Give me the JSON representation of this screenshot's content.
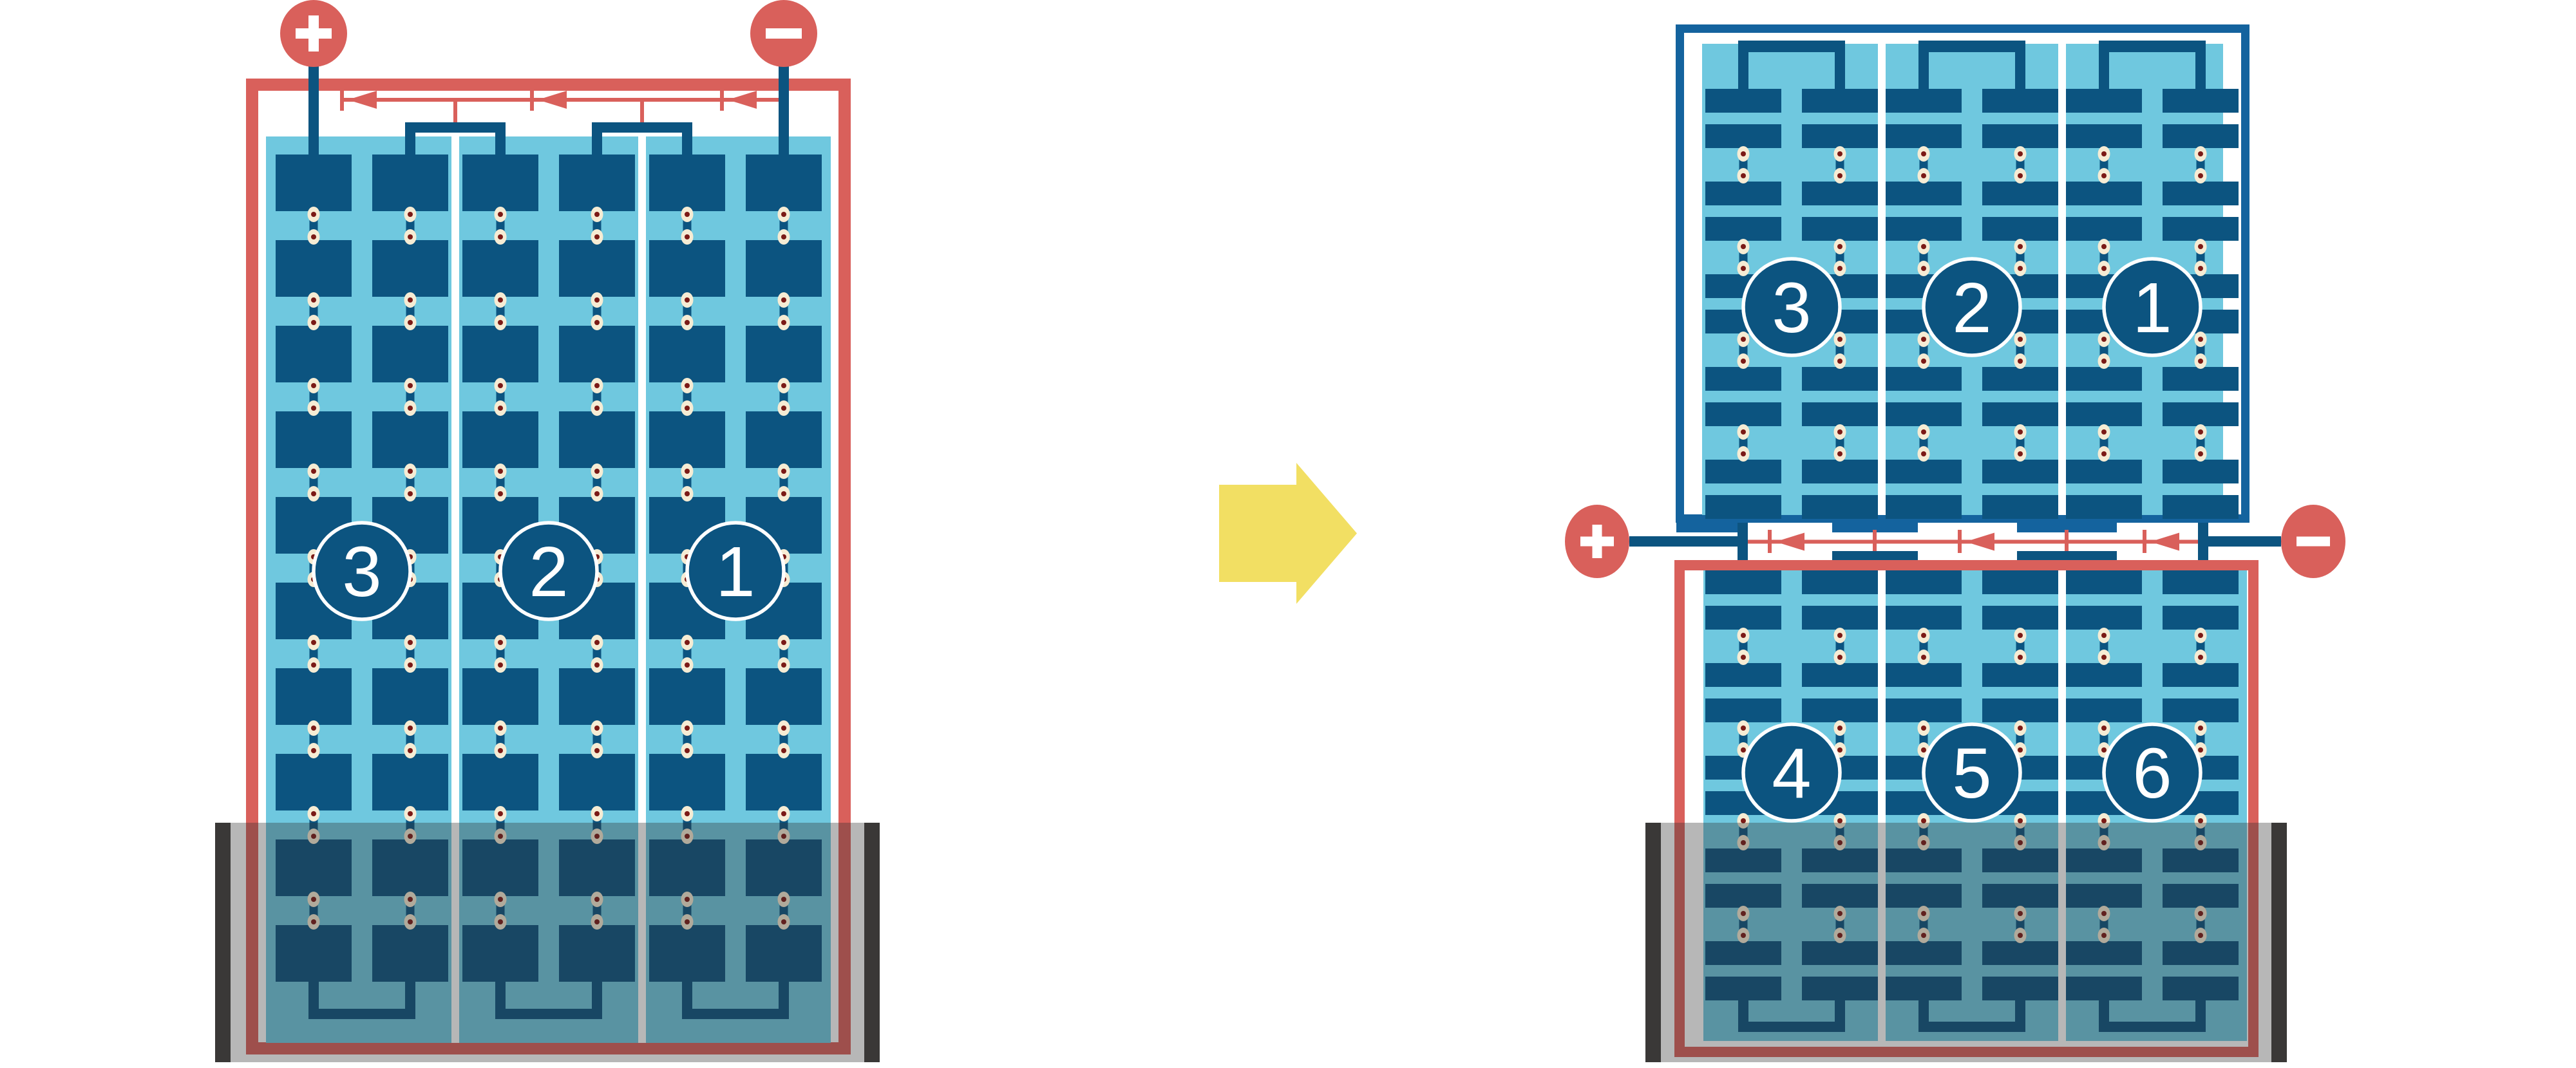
{
  "diagram_type": "battery-cell-arrangement-before-after",
  "colors": {
    "background": "#FFFFFF",
    "red": "#D9605B",
    "dark_blue": "#0C5480",
    "frame_blue": "#14639E",
    "light_blue": "#6FC8DF",
    "rivet_cream": "#F6ECD4",
    "rivet_dark_red": "#7B1A16",
    "arrow_yellow": "#F2DF63",
    "case_charcoal": "#3A3837",
    "overlay_gray": "rgba(50,50,50,0.35)"
  },
  "before": {
    "terminals": [
      {
        "name": "plus-terminal",
        "symbol": "+"
      },
      {
        "name": "minus-terminal",
        "symbol": "-"
      }
    ],
    "cells": [
      {
        "label": "3"
      },
      {
        "label": "2"
      },
      {
        "label": "1"
      }
    ]
  },
  "after": {
    "terminals": [
      {
        "name": "plus-terminal",
        "symbol": "+"
      },
      {
        "name": "minus-terminal",
        "symbol": "-"
      }
    ],
    "top_row_cells": [
      {
        "label": "3"
      },
      {
        "label": "2"
      },
      {
        "label": "1"
      }
    ],
    "bottom_row_cells": [
      {
        "label": "4"
      },
      {
        "label": "5"
      },
      {
        "label": "6"
      }
    ]
  },
  "transform_arrow": {
    "name": "transform-arrow",
    "direction": "right"
  }
}
